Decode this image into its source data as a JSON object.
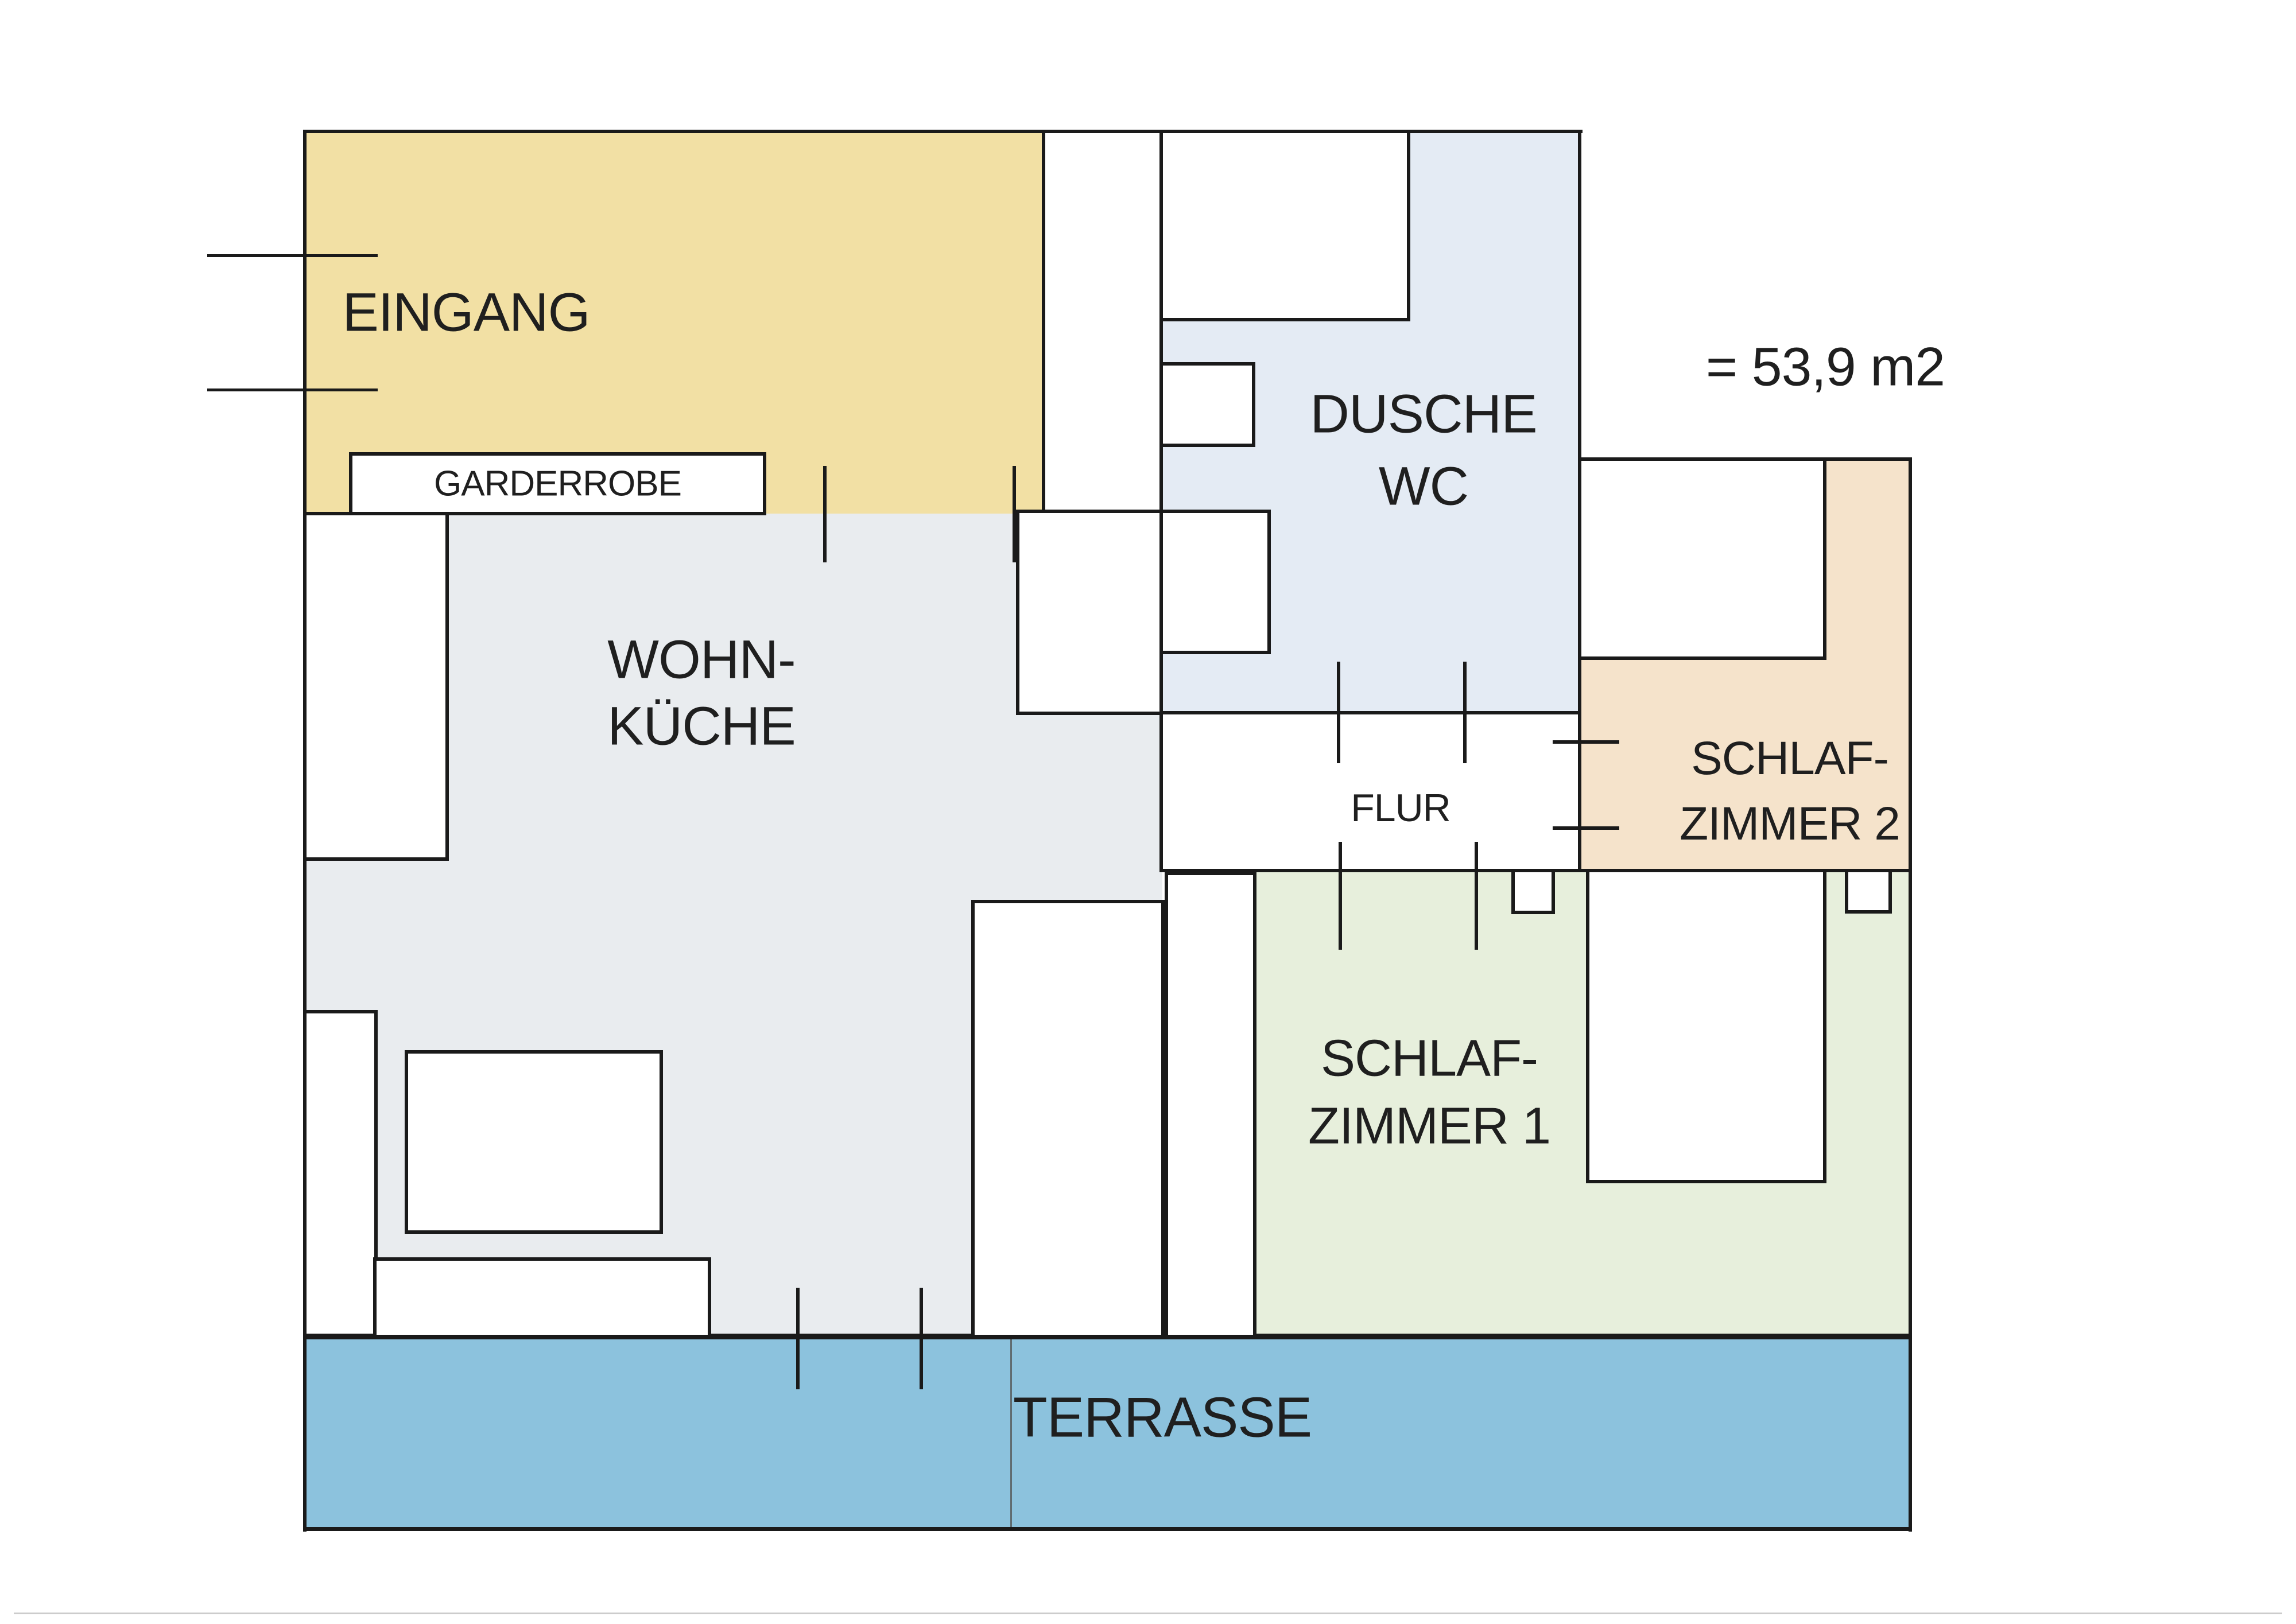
{
  "title": "Wohnung Grundriss (floor plan)",
  "annotation": {
    "area_label": "= 53,9 m2"
  },
  "rooms": {
    "eingang": {
      "label": "EINGANG",
      "color": "#F2E0A4"
    },
    "garderrobe": {
      "label": "GARDERROBE",
      "color": "#FFFFFF"
    },
    "dusche_wc": {
      "line1": "DUSCHE",
      "line2": "WC",
      "color": "#E4EBF4"
    },
    "wohn_kueche": {
      "line1": "WOHN-",
      "line2": "KÜCHE",
      "color": "#E9ECEF"
    },
    "flur": {
      "label": "FLUR",
      "color": "#FFFFFF"
    },
    "schlafzimmer2": {
      "line1": "SCHLAF-",
      "line2": "ZIMMER 2",
      "color": "#F5E3CB"
    },
    "schlafzimmer1": {
      "line1": "SCHLAF-",
      "line2": "ZIMMER 1",
      "color": "#E7EFDC"
    },
    "terrasse": {
      "label": "TERRASSE",
      "color": "#8CC2DD"
    }
  },
  "wall_color": "#1a1a1a"
}
